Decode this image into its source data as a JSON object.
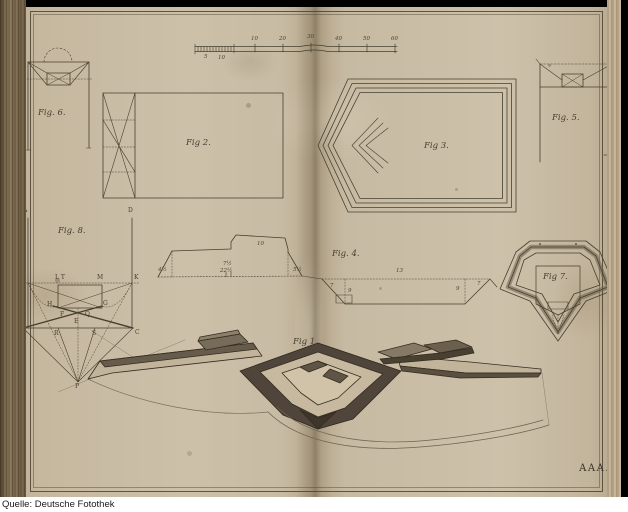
{
  "photo": {
    "caption": "Quelle: Deutsche Fotothek"
  },
  "plate": {
    "signature": "AAA.",
    "figure_labels": {
      "fig1": "Fig 1.",
      "fig2": "Fig 2.",
      "fig3": "Fig 3.",
      "fig4": "Fig. 4.",
      "fig5": "Fig. 5.",
      "fig6": "Fig. 6.",
      "fig7": "Fig 7.",
      "fig8": "Fig. 8."
    },
    "scale_bar": {
      "upper": [
        "10",
        "20",
        "30",
        "40",
        "50",
        "60"
      ],
      "lower": [
        "5",
        "10"
      ]
    },
    "fig8_letters": {
      "a": "A",
      "d": "D",
      "i": "I",
      "lt": "L T",
      "m": "M",
      "k": "K",
      "h": "H",
      "g": "G",
      "f": "F",
      "q": "Q",
      "e": "E",
      "b": "B",
      "r": "R",
      "s": "S",
      "c": "C",
      "p": "P"
    },
    "fig4_numbers": {
      "top": "10",
      "left": "4½",
      "mid_upper": "7½",
      "mid": "22½",
      "right": "5½",
      "ditch_top": "13",
      "ditch_left": "7",
      "ditch_right": "7",
      "ditch_inner_left": "9",
      "ditch_inner_right": "9"
    },
    "colors": {
      "paper": "#c9bca4",
      "ink": "#453d2f",
      "spine": "#7a684e",
      "frame": "#000000",
      "caption_bg": "#ffffff"
    }
  }
}
